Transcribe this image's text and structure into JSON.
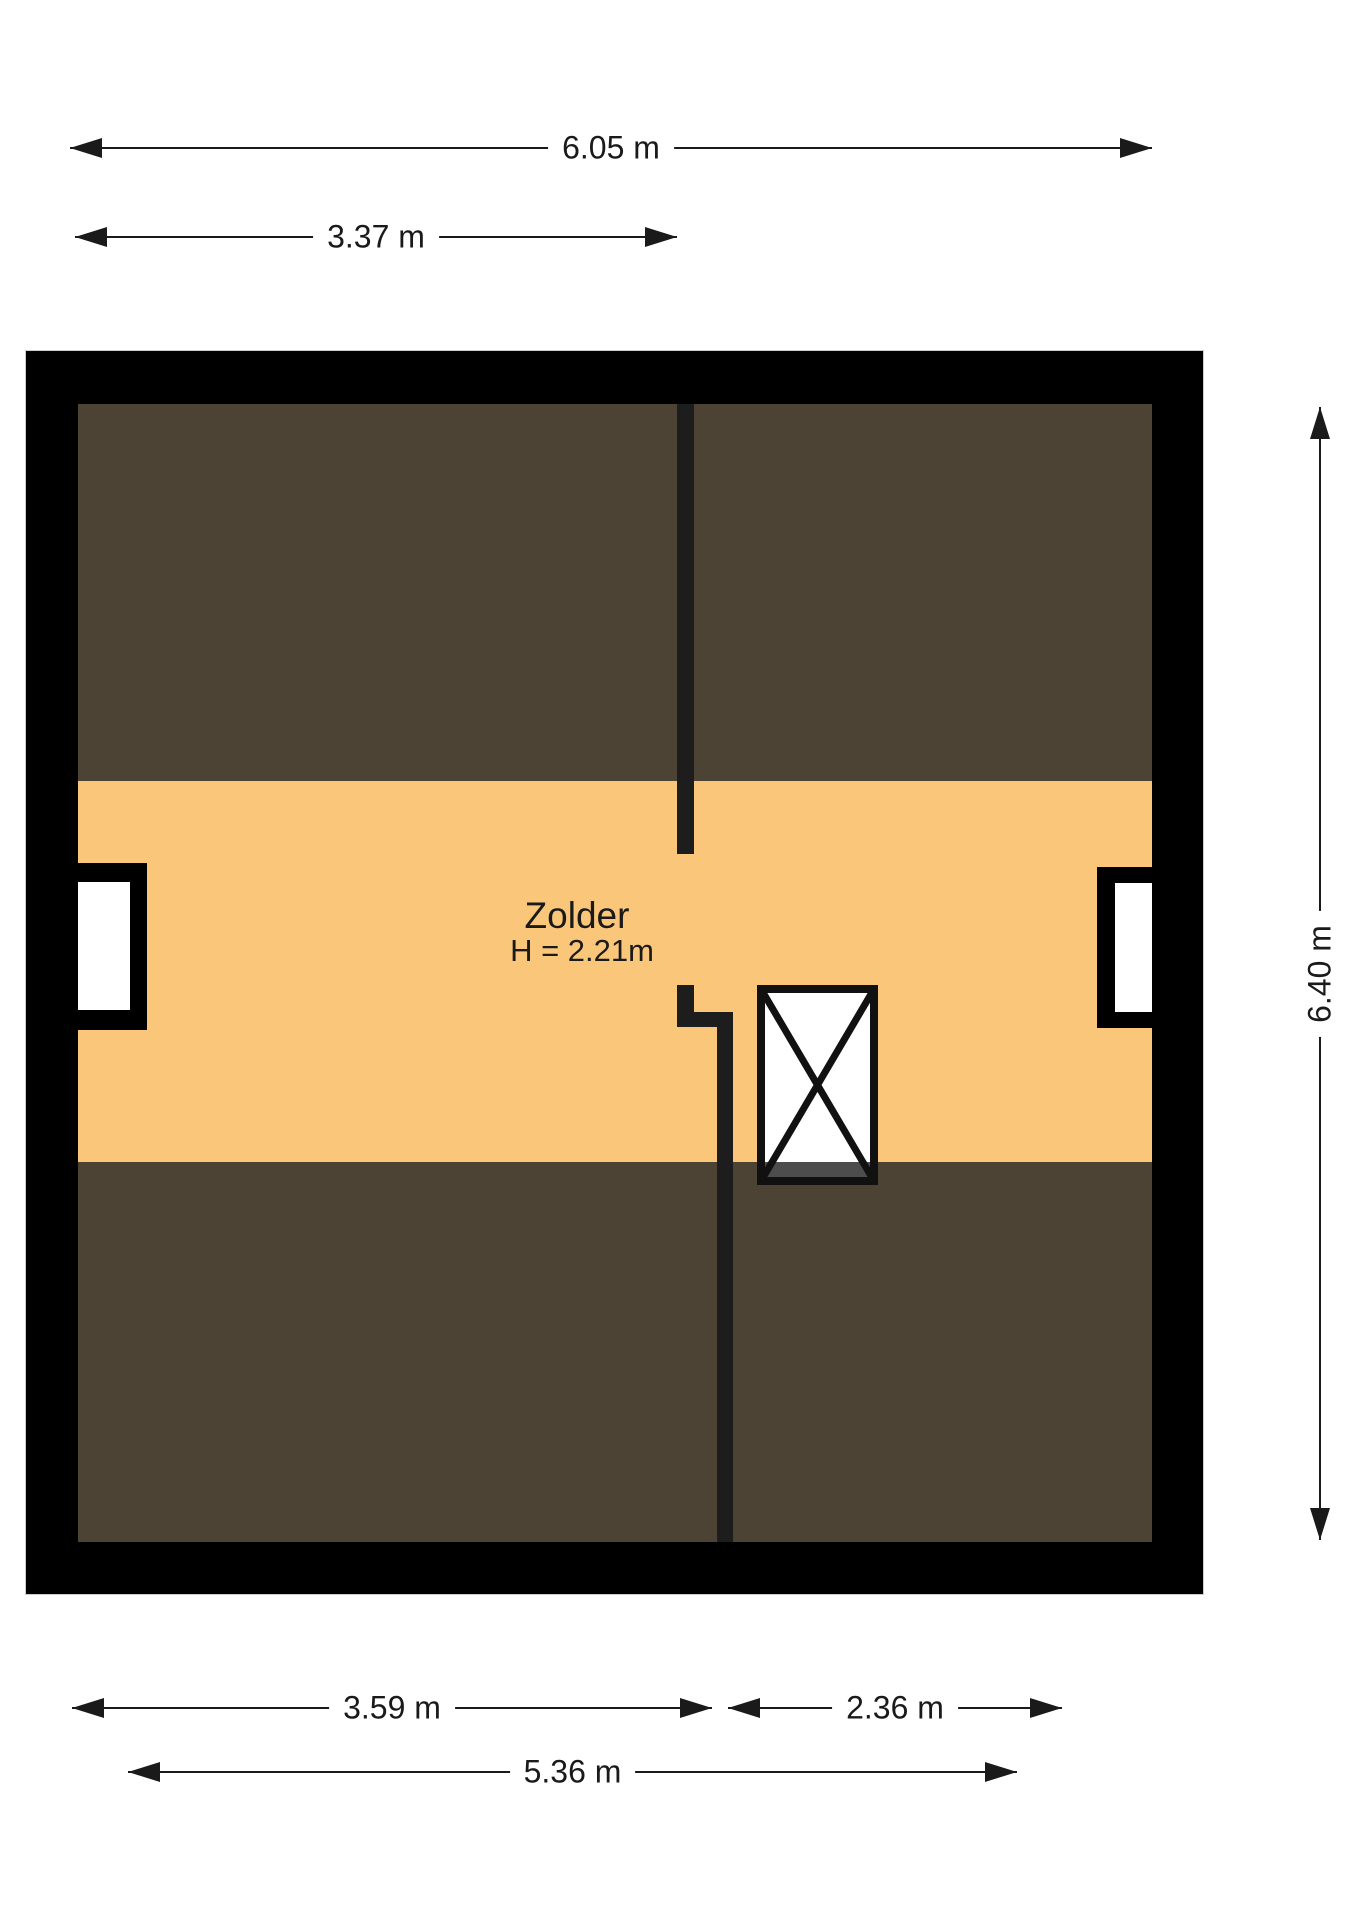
{
  "room": {
    "name": "Zolder",
    "height": "H = 2.21m"
  },
  "dimensions": {
    "top_outer": "6.05 m",
    "top_inner": "3.37 m",
    "right_vertical": "6.40 m",
    "bottom_left": "3.59 m",
    "bottom_right": "2.36 m",
    "bottom_overall": "5.36 m"
  },
  "colors": {
    "background": "#FFFFFF",
    "wall": "#000000",
    "interior_wall": "#1D1D1D",
    "floor_low": "#4C4335",
    "floor_main": "#FAC67A",
    "stair_shade": "#4D4D4D",
    "stair_frame": "#111111",
    "window_white": "#FFFFFF",
    "dim": "#1A1A1A",
    "plan_outline": "#CCCCCC"
  }
}
